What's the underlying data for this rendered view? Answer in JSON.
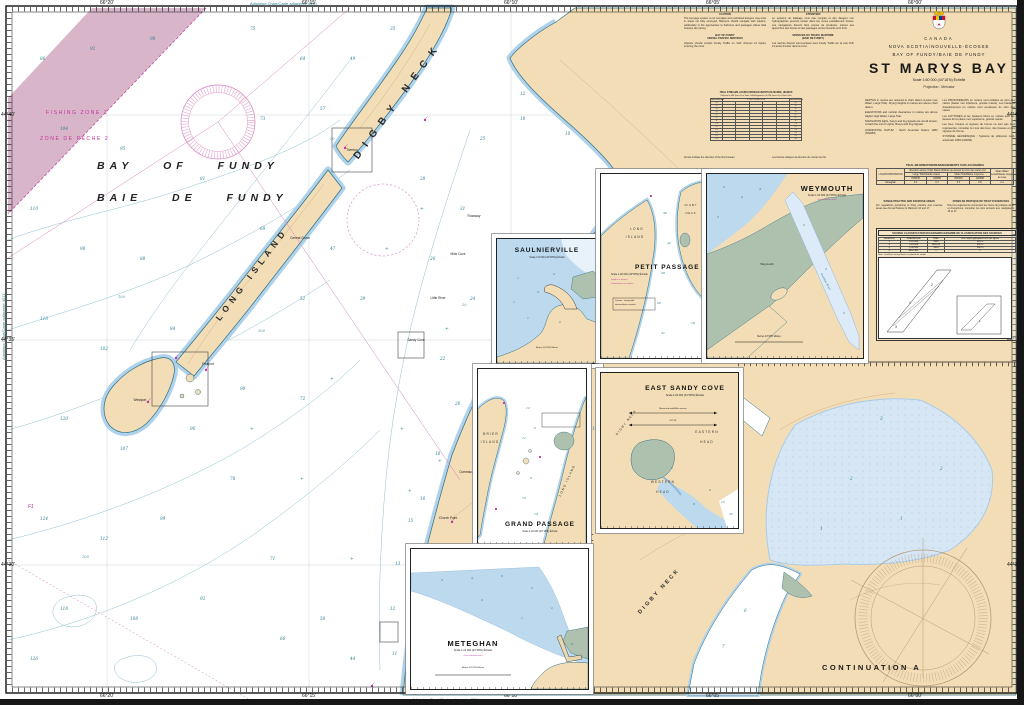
{
  "chart": {
    "country": "CANADA",
    "province": "NOVA SCOTIA/NOUVELLE-ÉCOSSE",
    "region": "BAY OF FUNDY/BAIE DE FUNDY",
    "title": "ST MARYS BAY",
    "scale": "Scale 1:60 000 (44°18'N) Échelle",
    "projection": "Projection : Mercator"
  },
  "geo_labels": {
    "bay_en": "BAY OF FUNDY",
    "bay_fr": "BAIE DE FUNDY",
    "fishing_en": "FISHING ZONE 2",
    "fishing_fr": "ZONE DE PÊCHE 2",
    "digby_neck": "DIGBY NECK",
    "long_island": "LONG ISLAND",
    "continuation": "CONTINUATION A",
    "continuation_neck": "DIGBY NECK",
    "f1": "F1"
  },
  "marginalia": {
    "adjoining_top": "Adjoining Chart/Carte adjacente 4340",
    "adjoining_bottom": "Adjoining Chart/Carte adjacente 4324",
    "adjoining_left": "Adjoining Chart/Carte adjacente 4011"
  },
  "graticule": {
    "top": [
      [
        107,
        "66°20'"
      ],
      [
        309,
        "66°15'"
      ],
      [
        511,
        "66°10'"
      ],
      [
        713,
        "66°05'"
      ],
      [
        915,
        "66°00'"
      ]
    ],
    "bottom": [
      [
        107,
        "66°20'"
      ],
      [
        309,
        "66°15'"
      ],
      [
        511,
        "66°10'"
      ],
      [
        713,
        "66°05'"
      ],
      [
        915,
        "66°00'"
      ]
    ],
    "left": [
      [
        115,
        "44°40'"
      ],
      [
        340,
        "44°35'"
      ],
      [
        565,
        "44°30'"
      ]
    ],
    "right": [
      [
        115,
        "44°40'"
      ],
      [
        340,
        "44°35'"
      ],
      [
        565,
        "44°30'"
      ]
    ]
  },
  "notes_top": {
    "h_en": "CAUTION",
    "h_fr": "ATTENTION",
    "p_en": "The buoyage system is not complete and uncharted dangers may exist in areas not fully surveyed. Mariners should navigate with caution, particularly in the approaches to harbours and passages where tidal streams are strong.",
    "p_fr": "Le système de balisage n'est pas complet et des dangers non hydrographiés peuvent exister dans les zones partiellement levées. Les navigateurs doivent faire preuve de prudence, surtout aux approches des havres et des passages où les courants sont forts.",
    "vts_en1": "BAY OF FUNDY",
    "vts_en2": "VESSEL TRAFFIC SERVICES",
    "vts_fr1": "SERVICES DU TRAFIC MARITIME",
    "vts_fr2": "(BAIE DE FUNDY)",
    "vts_p_en": "Vessels should contact Fundy Traffic on VHF channel 14 before entering the zone.",
    "vts_p_fr": "Les navires doivent communiquer avec Fundy Traffic sur la voie VHF 14 avant d'entrer dans la zone.",
    "arrow_en": "Arrows indicate the direction of the flood stream.",
    "arrow_fr": "Les flèches indiquent la direction du courant de flot."
  },
  "tidal_streams": {
    "title": "TIDAL STREAMS, HOURS FROM/COURANTS DE MARÉE, HEURES",
    "subtitle": "Referred to HW (hour 0) at Saint John/Rapportés à la PM (heure 0) à Saint John",
    "station": "✶ 44°21'N 66°14'W",
    "col_hours": "Hours/Heures",
    "hours": [
      "-6",
      "-5",
      "-4",
      "-3",
      "-2",
      "-1",
      "0",
      "+1",
      "+2",
      "+3",
      "+4",
      "+5",
      "+6"
    ]
  },
  "notes_right": {
    "en1": "DEPTHS in metres are reduced to chart datum (Lower Low Water, Large Tide). Drying heights in metres are above chart datum.",
    "en2": "ELEVATIONS and vertical clearances in metres are above Higher High Water, Large Tide.",
    "en3": "NAVIGATION lights, buoys and fog signals are not all shown; consult the List of Lights, Buoys and Fog Signals.",
    "en4": "HORIZONTAL DATUM : North American Datum 1983 (NAD83).",
    "fr1": "Les PROFONDEURS en mètres sont réduites au zéro des cartes (basse mer inférieure, grande marée). Les hauteurs d'assèchement en mètres sont au-dessus du zéro des cartes.",
    "fr2": "Les ALTITUDES et les hauteurs libres en mètres sont au-dessus de la pleine mer supérieure, grande marée.",
    "fr3": "Les feux, bouées et signaux de brume ne sont pas tous représentés; consulter le Livre des feux, des bouées et des signaux de brume.",
    "fr4": "SYSTÈME GÉODÉSIQUE : Système de référence nord-américain 1983 (NAD83)."
  },
  "tidal_info": {
    "title": "TIDAL INFORMATION/RENSEIGNEMENTS SUR LES MARÉES",
    "h_loc": "LOCATION/POSITION",
    "h_elev": "Elevation above Chart Datum/Altitude au-dessus du zéro des cartes (m)",
    "h_large": "Large Tide/Grande marée",
    "h_mean": "Mean Tide/Marée moyenne",
    "h_hw": "HW/PM",
    "h_lw": "LW/BM",
    "h_mwl": "Mean Water Level/Niveau moyen de l'eau",
    "row": {
      "name": "Meteghan",
      "lhw": "4.1",
      "llw": "0.1",
      "mhw": "3.3",
      "mlw": "0.8",
      "mwl": "2.1"
    }
  },
  "range": {
    "en_h": "RANGE PRACTICE AND EXERCISE AREAS",
    "en_p": "For regulations pertaining to firing practice and exercise areas see Annual Notices to Mariners 16 and 17.",
    "fr_h": "ZONES DE PRATIQUE DE TIR ET D'EXERCICES",
    "fr_p": "Pour les règlements concernant les zones de pratique de tir et d'exercices, consulter les Avis annuels aux navigateurs 16 et 17."
  },
  "source": {
    "title": "SOURCE CLASSIFICATION DIAGRAM/DIAGRAMME DE CLASSIFICATION DES SOURCES",
    "cols": [
      "Area/Zone",
      "Scale/Échelle",
      "Date",
      "Line Spacing/Espacement des lignes"
    ],
    "rows": [
      [
        "1",
        "1:12 000",
        "1960",
        "125 m"
      ],
      [
        "2",
        "1:24 000",
        "1942-44",
        "250 m"
      ],
      [
        "3",
        "1:36 500",
        "1934",
        "500 m"
      ],
      [
        "4",
        "Misc./Div.",
        "—",
        "—"
      ]
    ],
    "note": "Note : lead-line surveys/levés au plomb de sonde"
  },
  "insets": {
    "saulnierville": {
      "title": "SAULNIERVILLE",
      "scale": "Scale 1:5 000 (44°18'N) Échelle",
      "bar": "Metres 44°18'N Mètres"
    },
    "petit_passage": {
      "title": "PETIT PASSAGE",
      "scale": "Scale 1:20 000 (44°18'N) Échelle",
      "mag1": "Depths in metres",
      "mag2": "Profondeurs en mètres",
      "l1": "LONG",
      "l2": "ISLAND",
      "l3": "DIGBY",
      "l4": "NECK",
      "note1": "Caution : strong tidal",
      "note2": "streams/forts courants"
    },
    "weymouth": {
      "title": "WEYMOUTH",
      "scale": "Scale 1:10 000 (44°18'N) Échelle",
      "mag": "(see note/voir note)",
      "town": "Weymouth",
      "river": "Sissiboo River",
      "bar": "Metres 44°18'N Mètres"
    },
    "east_sandy_cove": {
      "title": "EAST SANDY COVE",
      "scale": "Scale 1:20 000 (44°18'N) Échelle",
      "neck": "DIGBY NECK",
      "e1": "EASTERN",
      "e2": "HEAD",
      "w1": "WESTERN",
      "w2": "HEAD",
      "mile1": "Measured mile/Mille mesuré",
      "mile2": "247°30'"
    },
    "grand_passage": {
      "title": "GRAND PASSAGE",
      "scale": "Scale 1:20 000 (44°18'N) Échelle",
      "b1": "BRIER",
      "b2": "ISLAND",
      "l1": "LONG ISLAND"
    },
    "meteghan": {
      "title": "METEGHAN",
      "scale": "Scale 1:10 000 (44°18'N) Échelle",
      "mag": "(see note/voir note)",
      "bar": "Metres 44°18'N Mètres"
    }
  },
  "place_names": [
    [
      352,
      150,
      "Tiverton"
    ],
    [
      300,
      238,
      "Central Grove"
    ],
    [
      208,
      364,
      "Freeport"
    ],
    [
      140,
      400,
      "Westport"
    ],
    [
      416,
      340,
      "Sandy Cove"
    ],
    [
      438,
      298,
      "Little River"
    ],
    [
      458,
      254,
      "Mink Cove"
    ],
    [
      474,
      216,
      "Rossway"
    ],
    [
      448,
      518,
      "Church Point"
    ],
    [
      468,
      472,
      "Comeauville"
    ]
  ],
  "contour_labels": [
    [
      330,
      140,
      "50"
    ],
    [
      258,
      332,
      "100"
    ],
    [
      118,
      298,
      "100"
    ],
    [
      82,
      558,
      "100"
    ],
    [
      462,
      306,
      "20"
    ]
  ],
  "rocks": [
    [
      420,
      210
    ],
    [
      445,
      330
    ],
    [
      400,
      430
    ],
    [
      438,
      462
    ],
    [
      408,
      492
    ],
    [
      300,
      480
    ],
    [
      250,
      430
    ],
    [
      350,
      560
    ],
    [
      385,
      250
    ],
    [
      330,
      380
    ]
  ],
  "lights": [
    [
      345,
      148
    ],
    [
      176,
      358
    ],
    [
      206,
      370
    ],
    [
      148,
      402
    ],
    [
      452,
      522
    ],
    [
      372,
      686
    ],
    [
      425,
      120
    ]
  ],
  "soundings": {
    "main": [
      [
        40,
        60,
        "86"
      ],
      [
        90,
        50,
        "92"
      ],
      [
        150,
        40,
        "98"
      ],
      [
        250,
        30,
        "75"
      ],
      [
        300,
        60,
        "64"
      ],
      [
        60,
        130,
        "104"
      ],
      [
        120,
        150,
        "95"
      ],
      [
        30,
        210,
        "110"
      ],
      [
        80,
        250,
        "98"
      ],
      [
        140,
        260,
        "88"
      ],
      [
        40,
        320,
        "116"
      ],
      [
        100,
        350,
        "102"
      ],
      [
        170,
        330,
        "84"
      ],
      [
        60,
        420,
        "120"
      ],
      [
        120,
        450,
        "107"
      ],
      [
        190,
        430,
        "96"
      ],
      [
        40,
        520,
        "124"
      ],
      [
        100,
        540,
        "112"
      ],
      [
        160,
        520,
        "99"
      ],
      [
        230,
        480,
        "78"
      ],
      [
        60,
        610,
        "118"
      ],
      [
        130,
        620,
        "108"
      ],
      [
        200,
        600,
        "92"
      ],
      [
        270,
        560,
        "71"
      ],
      [
        320,
        620,
        "58"
      ],
      [
        280,
        640,
        "66"
      ],
      [
        350,
        660,
        "44"
      ],
      [
        30,
        660,
        "126"
      ],
      [
        240,
        390,
        "90"
      ],
      [
        300,
        300,
        "52"
      ],
      [
        330,
        250,
        "47"
      ],
      [
        360,
        300,
        "39"
      ],
      [
        300,
        400,
        "72"
      ],
      [
        260,
        230,
        "69"
      ],
      [
        200,
        180,
        "81"
      ],
      [
        260,
        120,
        "73"
      ],
      [
        320,
        110,
        "57"
      ],
      [
        350,
        60,
        "49"
      ],
      [
        390,
        30,
        "35"
      ],
      [
        420,
        180,
        "28"
      ],
      [
        460,
        210,
        "31"
      ],
      [
        430,
        260,
        "26"
      ],
      [
        470,
        300,
        "24"
      ],
      [
        440,
        360,
        "22"
      ],
      [
        455,
        405,
        "20"
      ],
      [
        435,
        455,
        "18"
      ],
      [
        420,
        500,
        "16"
      ],
      [
        408,
        522,
        "15"
      ],
      [
        395,
        565,
        "13"
      ],
      [
        390,
        610,
        "12"
      ],
      [
        392,
        655,
        "11"
      ],
      [
        592,
        430,
        "14"
      ],
      [
        744,
        612,
        "6"
      ],
      [
        722,
        648,
        "7"
      ],
      [
        480,
        140,
        "25"
      ],
      [
        520,
        120,
        "18"
      ],
      [
        520,
        95,
        "12"
      ],
      [
        565,
        135,
        "10"
      ],
      [
        850,
        480,
        "2"
      ],
      [
        900,
        520,
        "1"
      ],
      [
        940,
        470,
        "2"
      ],
      [
        820,
        530,
        "1"
      ],
      [
        880,
        420,
        "3"
      ]
    ],
    "insets": {
      "sa": [
        [
          20,
          40,
          "1"
        ],
        [
          40,
          54,
          "2"
        ],
        [
          56,
          36,
          "2"
        ],
        [
          30,
          80,
          "1"
        ],
        [
          62,
          84,
          "0"
        ],
        [
          16,
          64,
          "1"
        ]
      ],
      "pp": [
        [
          62,
          40,
          "30"
        ],
        [
          66,
          70,
          "42"
        ],
        [
          60,
          100,
          "38"
        ],
        [
          56,
          130,
          "26"
        ],
        [
          60,
          160,
          "31"
        ],
        [
          90,
          150,
          "18"
        ]
      ],
      "wy": [
        [
          16,
          14,
          "5"
        ],
        [
          34,
          24,
          "4"
        ],
        [
          10,
          44,
          "3"
        ],
        [
          52,
          16,
          "4"
        ],
        [
          96,
          52,
          "2"
        ],
        [
          118,
          96,
          "2"
        ],
        [
          136,
          140,
          "2"
        ]
      ],
      "es": [
        [
          120,
          130,
          "15"
        ],
        [
          128,
          142,
          "22"
        ],
        [
          108,
          118,
          "9"
        ],
        [
          92,
          132,
          "6"
        ],
        [
          70,
          96,
          "2"
        ]
      ],
      "gp": [
        [
          48,
          40,
          "12"
        ],
        [
          56,
          60,
          "9"
        ],
        [
          44,
          70,
          "11"
        ],
        [
          52,
          110,
          "8"
        ],
        [
          44,
          130,
          "10"
        ],
        [
          56,
          146,
          "14"
        ]
      ],
      "me": [
        [
          30,
          32,
          "3"
        ],
        [
          60,
          30,
          "4"
        ],
        [
          90,
          28,
          "3"
        ],
        [
          120,
          40,
          "2"
        ],
        [
          140,
          60,
          "2"
        ],
        [
          110,
          70,
          "1"
        ],
        [
          70,
          52,
          "2"
        ],
        [
          160,
          96,
          "0"
        ]
      ]
    }
  }
}
